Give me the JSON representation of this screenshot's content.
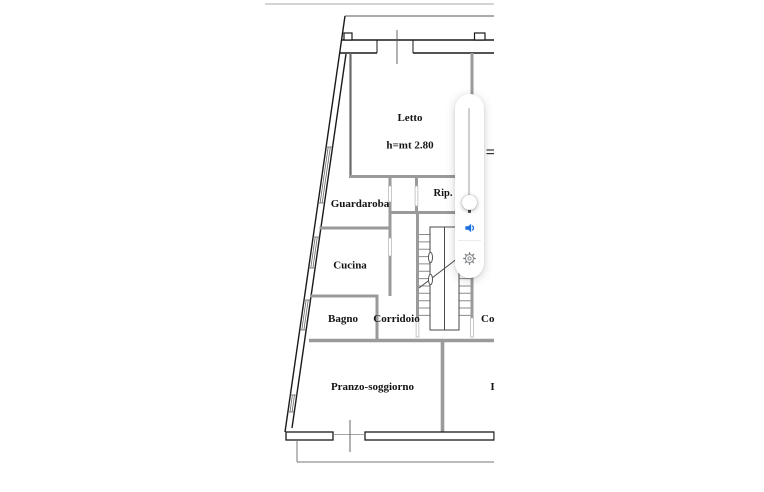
{
  "app": {
    "description": "Italian apartment floor plan image with a floating volume/settings control overlay",
    "background_color": "#ffffff"
  },
  "floor_plan": {
    "rooms": {
      "letto": "Letto",
      "letto_height_note": "h=mt 2.80",
      "guardaroba": "Guardaroba",
      "rip": "Rip.",
      "cucina": "Cucina",
      "bagno": "Bagno",
      "corridoio": "Corridoio",
      "pranzo_soggiorno": "Pranzo-soggiorno",
      "partial_label_right": "Co",
      "partial_label_bottom_right": "I"
    },
    "colors": {
      "outer_wall": "#1a1a1a",
      "inner_wall": "#9a9a9a",
      "label_text": "#141414"
    },
    "features": [
      "staircase",
      "windows",
      "doors",
      "balcony-edge"
    ]
  },
  "overlay": {
    "type": "volume-control",
    "slider": {
      "orientation": "vertical",
      "thumb_position_percent_from_top": 93
    },
    "icons": {
      "volume": "speaker-icon",
      "settings": "gear-icon"
    },
    "colors": {
      "speaker_blue": "#1a6ee0",
      "gear_gray": "#84878a",
      "track_gray": "#cfcfcf"
    }
  }
}
